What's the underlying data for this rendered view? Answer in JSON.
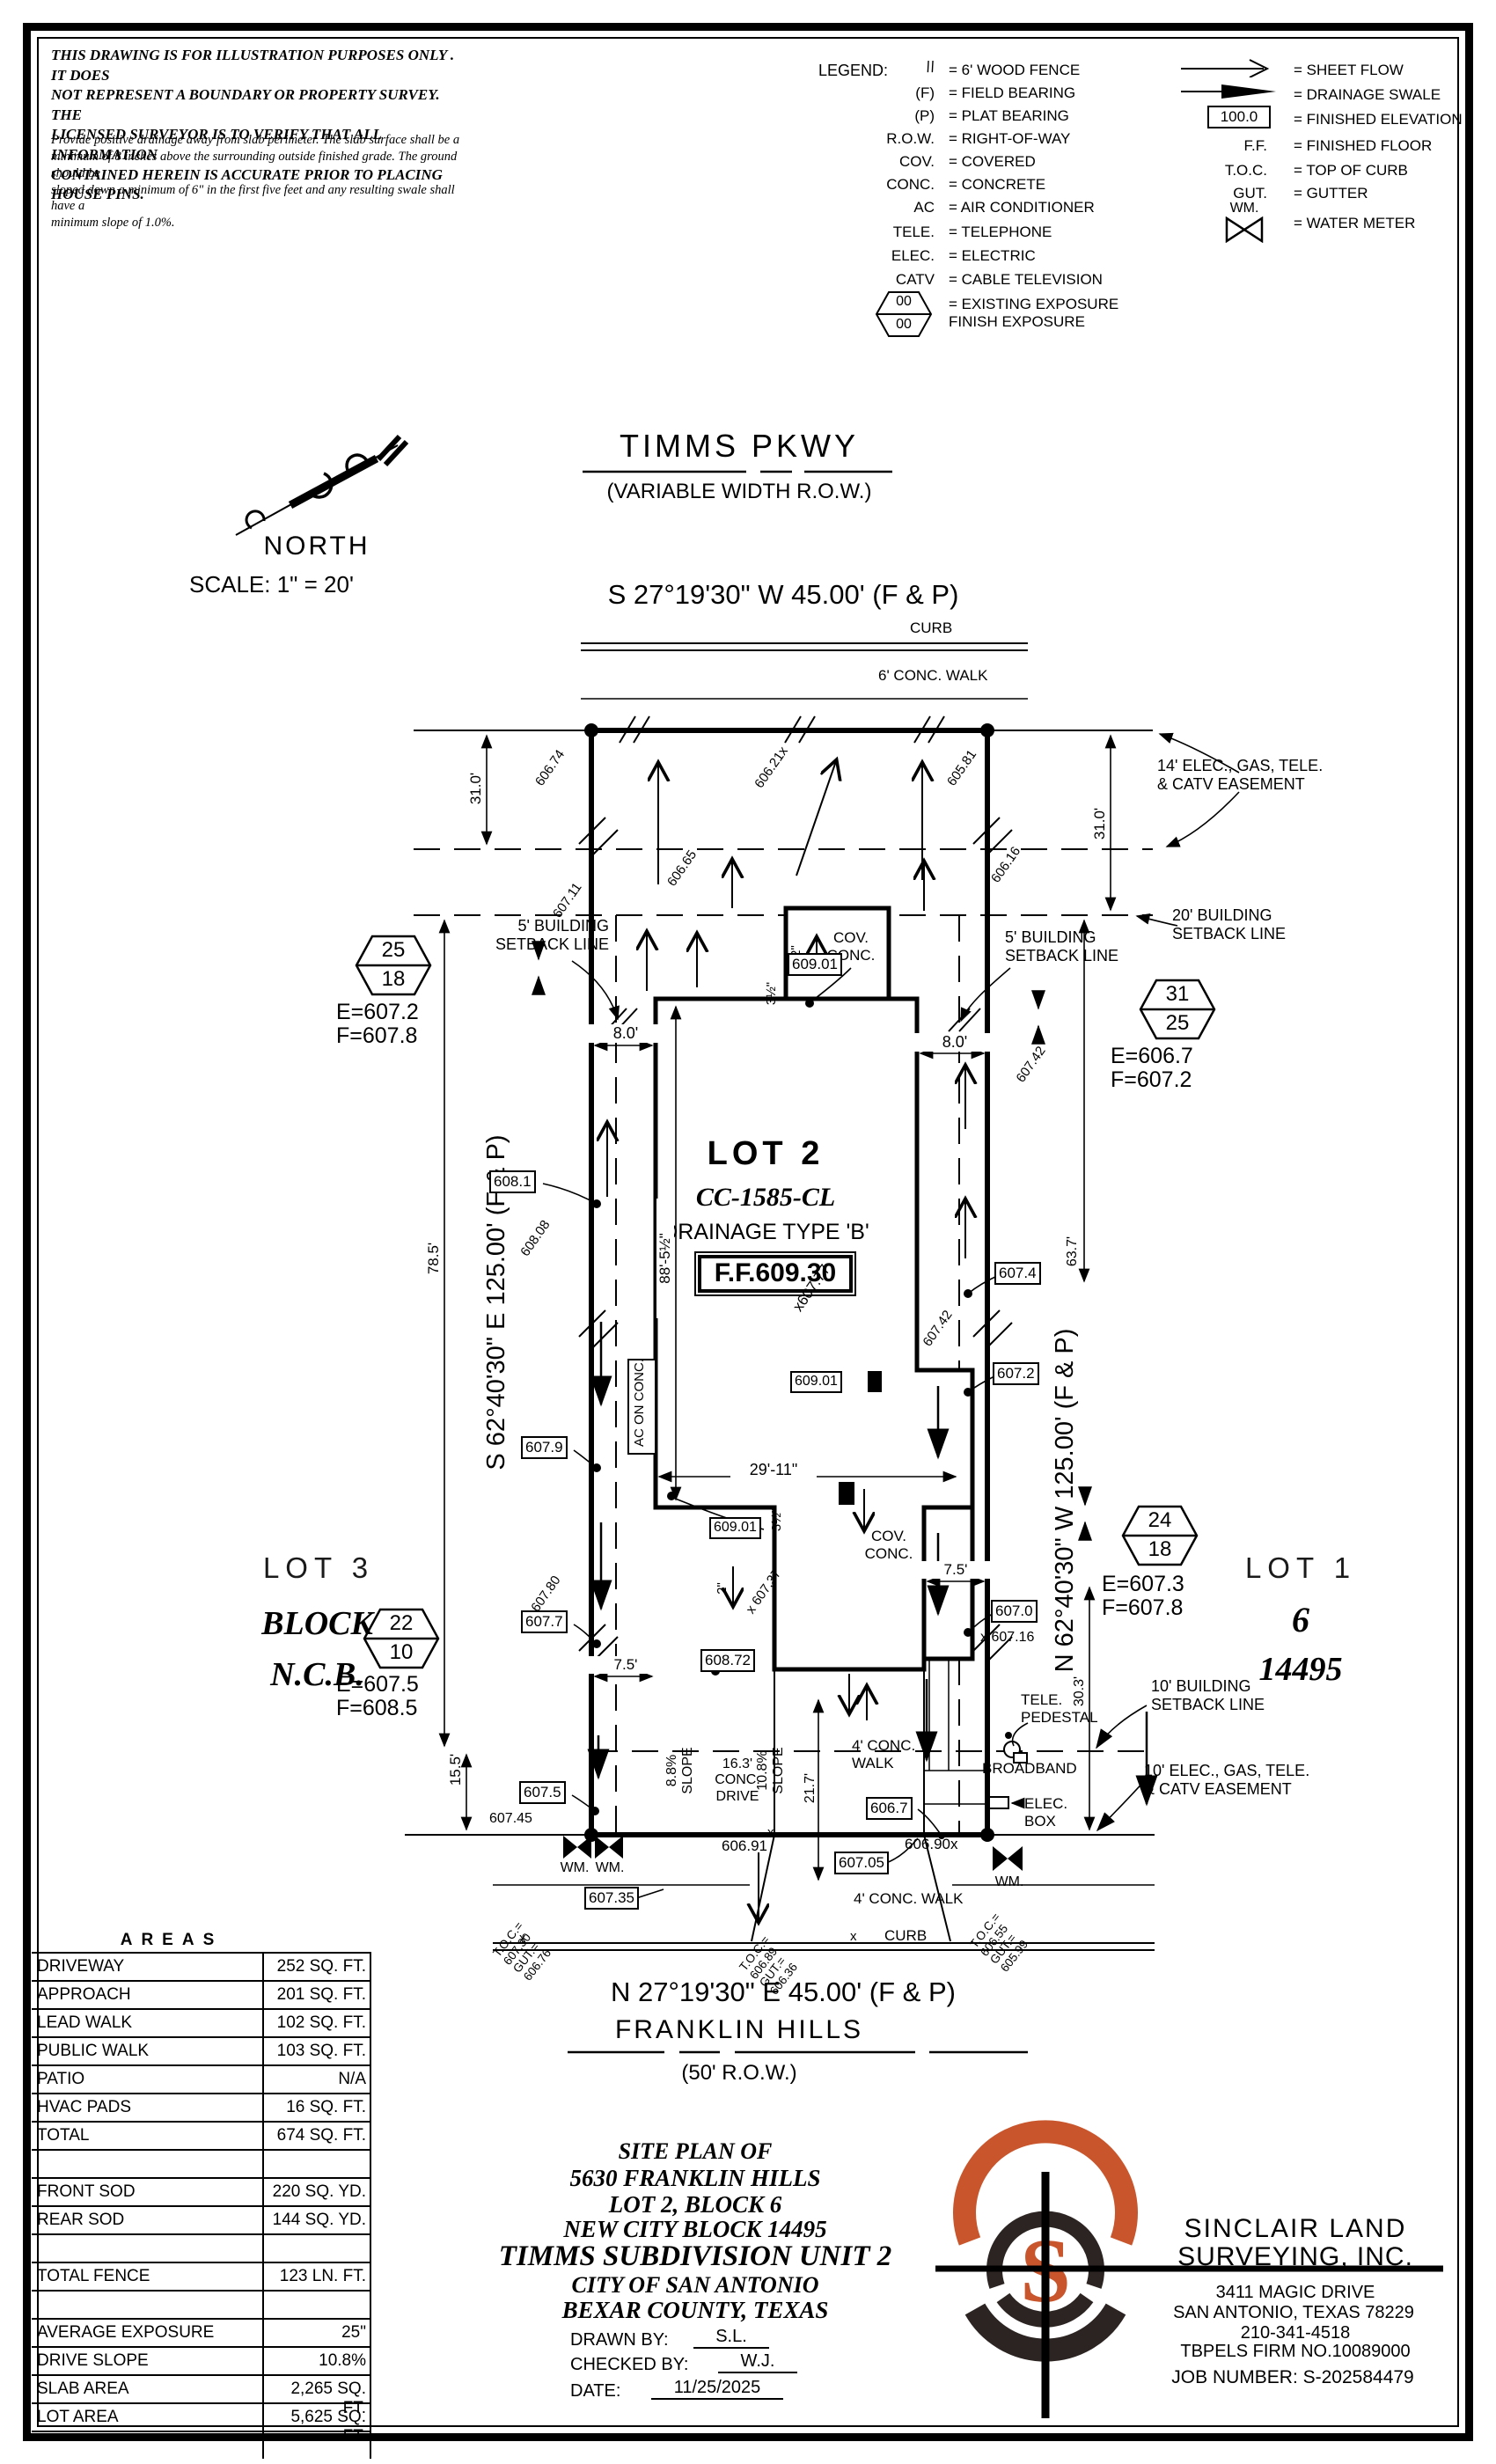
{
  "disclaimer": {
    "p1": "THIS DRAWING IS FOR ILLUSTRATION PURPOSES ONLY . IT DOES\nNOT REPRESENT A BOUNDARY OR PROPERTY SURVEY. THE\nLICENSED SURVEYOR IS TO VERIFY THAT ALL INFORMATION\nCONTAINED HEREIN IS ACCURATE PRIOR TO PLACING HOUSE PINS.",
    "p2": "Provide positive drainage away from slab perimeter. The slab surface shall be a\nminimum of 8 inches above the surrounding outside finished grade. The ground should be\nsloped down a minimum of 6\" in the first five feet and any resulting swale shall have a\nminimum slope of 1.0%."
  },
  "legend": {
    "title": "LEGEND:",
    "hex_top": "00",
    "hex_bot": "00",
    "left": [
      {
        "s": "\\\\",
        "t": "= 6' WOOD FENCE"
      },
      {
        "s": "(F)",
        "t": "= FIELD BEARING"
      },
      {
        "s": "(P)",
        "t": "= PLAT BEARING"
      },
      {
        "s": "R.O.W.",
        "t": "= RIGHT-OF-WAY"
      },
      {
        "s": "COV.",
        "t": "= COVERED"
      },
      {
        "s": "CONC.",
        "t": "= CONCRETE"
      },
      {
        "s": "AC",
        "t": "= AIR CONDITIONER"
      },
      {
        "s": "TELE.",
        "t": "= TELEPHONE"
      },
      {
        "s": "ELEC.",
        "t": "= ELECTRIC"
      },
      {
        "s": "CATV",
        "t": "= CABLE TELEVISION"
      },
      {
        "s": "",
        "t": "= EXISTING EXPOSURE\nFINISH EXPOSURE"
      }
    ],
    "right": [
      {
        "s": "",
        "t": "= SHEET FLOW"
      },
      {
        "s": "",
        "t": "= DRAINAGE SWALE"
      },
      {
        "s": "100.0",
        "t": "= FINISHED ELEVATION"
      },
      {
        "s": "F.F.",
        "t": "= FINISHED FLOOR"
      },
      {
        "s": "T.O.C.",
        "t": "= TOP OF CURB"
      },
      {
        "s": "GUT.",
        "t": "= GUTTER"
      },
      {
        "s": "WM.",
        "t": "= WATER METER"
      }
    ]
  },
  "north": {
    "label": "NORTH",
    "scale": "SCALE: 1\" = 20'"
  },
  "st": {
    "name": "TIMMS PKWY",
    "row": "(VARIABLE WIDTH R.O.W.)",
    "bearing": "S 27°19'30\" W 45.00' (F & P)",
    "curb": "CURB",
    "walk": "6' CONC. WALK"
  },
  "sb": {
    "bearing": "N 27°19'30\" E 45.00' (F & P)",
    "name": "FRANKLIN HILLS",
    "row": "(50' R.O.W.)",
    "walk": "4' CONC. WALK",
    "curb": "CURB"
  },
  "lot2": {
    "name": "LOT 2",
    "cc": "CC-1585-CL",
    "drn": "DRAINAGE TYPE 'B'",
    "ff": "F.F.609.30",
    "spot": "x607.77"
  },
  "lot3": {
    "a": "LOT 3",
    "b": "BLOCK",
    "c": "N.C.B."
  },
  "lot1": {
    "a": "LOT 1",
    "b": "6",
    "c": "14495"
  },
  "brg": {
    "left": "S 62°40'30\" E 125.00' (F & P)",
    "right": "N 62°40'30\" W 125.00' (F & P)"
  },
  "flags": {
    "nw": {
      "t": "25",
      "b": "18",
      "e": "E=607.2",
      "f": "F=607.8"
    },
    "ne": {
      "t": "31",
      "b": "25",
      "e": "E=606.7",
      "f": "F=607.2"
    },
    "se": {
      "t": "24",
      "b": "18",
      "e": "E=607.3",
      "f": "F=607.8"
    },
    "sw": {
      "t": "22",
      "b": "10",
      "e": "E=607.5",
      "f": "F=608.5"
    }
  },
  "lbl": {
    "e14": "14' ELEC., GAS, TELE.\n& CATV EASEMENT",
    "s20": "20' BUILDING\nSETBACK LINE",
    "s5l": "5' BUILDING\nSETBACK LINE",
    "s5r": "5' BUILDING\nSETBACK LINE",
    "s10": "10' BUILDING\nSETBACK LINE",
    "e10": "10' ELEC., GAS, TELE.\n& CATV EASEMENT",
    "covt": "COV.\nCONC.",
    "covm": "COV.\nCONC.",
    "ac": "AC ON CONC.",
    "tp": "TELE.\nPEDESTAL",
    "bb": "BROADBAND",
    "eb": "ELEC.\nBOX",
    "drive": "16.3'\nCONC.\nDRIVE",
    "sll": "8.8%\nSLOPE",
    "slr": "10.8%\nSLOPE",
    "w4t": "4' CONC.\nWALK",
    "w4b": "4' CONC. WALK",
    "wm": "WM."
  },
  "dims": {
    "d31l": "31.0'",
    "d31r": "31.0'",
    "d785": "78.5'",
    "d155": "15.5'",
    "d637": "63.7'",
    "d303": "30.3'",
    "d217": "21.7'",
    "d80l": "8.0'",
    "d80r": "8.0'",
    "d885": "88'-5½\"",
    "d2911": "29'-11\"",
    "d75l": "7.5'",
    "d75r": "7.5'",
    "d2": "2\"",
    "d35": "3½\""
  },
  "sp": {
    "s60674": "606.74",
    "s60621": "606.21x",
    "s60581": "605.81",
    "s60665": "606.65",
    "s60616": "606.16",
    "s60711": "607.11",
    "b6081": "608.1",
    "s60808": "608.08",
    "b6079": "607.9",
    "s60780": "607.80",
    "b6077": "607.7",
    "b6075": "607.5",
    "s60745": "607.45",
    "b60901": "609.01",
    "b60872": "608.72",
    "s60737": "x 607.37",
    "s60742": "607.42",
    "b6074": "607.4",
    "b6072": "607.2",
    "b6070": "607.0",
    "s60716": "x 607.16",
    "s60691": "606.91",
    "b60705": "607.05",
    "b6067": "606.7",
    "s60690": "606.90x",
    "b60735": "607.35",
    "toc1": "T.O.C.=\n607.30\nGUT.=\n606.76",
    "toc2": "T.O.C.=\n606.89\nGUT.=\n606.36",
    "toc3": "T.O.C.=\n606.55\nGUT.=\n605.99"
  },
  "x": "x",
  "areas": {
    "title": "AREAS",
    "rows": [
      {
        "l": "DRIVEWAY",
        "v": "252 SQ. FT."
      },
      {
        "l": "APPROACH",
        "v": "201 SQ. FT."
      },
      {
        "l": "LEAD WALK",
        "v": "102 SQ. FT."
      },
      {
        "l": "PUBLIC WALK",
        "v": "103 SQ. FT."
      },
      {
        "l": "PATIO",
        "v": "N/A"
      },
      {
        "l": "HVAC PADS",
        "v": "16 SQ. FT."
      },
      {
        "l": "TOTAL",
        "v": "674 SQ. FT."
      },
      {
        "l": "",
        "v": ""
      },
      {
        "l": "FRONT SOD",
        "v": "220 SQ. YD."
      },
      {
        "l": "REAR SOD",
        "v": "144 SQ. YD."
      },
      {
        "l": "",
        "v": ""
      },
      {
        "l": "TOTAL FENCE",
        "v": "123 LN. FT."
      },
      {
        "l": "",
        "v": ""
      },
      {
        "l": "AVERAGE EXPOSURE",
        "v": "25\""
      },
      {
        "l": "DRIVE SLOPE",
        "v": "10.8%"
      },
      {
        "l": "SLAB AREA",
        "v": "2,265 SQ. FT."
      },
      {
        "l": "LOT AREA",
        "v": "5,625 SQ. FT."
      },
      {
        "l": "",
        "v": ""
      }
    ]
  },
  "tb": {
    "l1": "SITE PLAN OF",
    "l2": "5630 FRANKLIN HILLS",
    "l3": "LOT 2, BLOCK 6",
    "l4": "NEW CITY BLOCK 14495",
    "l5": "TIMMS SUBDIVISION UNIT 2",
    "l6": "CITY OF SAN ANTONIO",
    "l7": "BEXAR COUNTY, TEXAS",
    "dl": "DRAWN BY:",
    "dv": "S.L.",
    "cl": "CHECKED BY:",
    "cv": "W.J.",
    "dtl": "DATE:",
    "dtv": "11/25/2025"
  },
  "firm": {
    "n1": "SINCLAIR LAND",
    "n2": "SURVEYING, INC.",
    "a1": "3411 MAGIC DRIVE",
    "a2": "SAN ANTONIO, TEXAS 78229",
    "a3": "210-341-4518",
    "a4": "TBPELS FIRM NO.10089000",
    "job": "JOB NUMBER: S-202584479",
    "logo_s": "S"
  }
}
